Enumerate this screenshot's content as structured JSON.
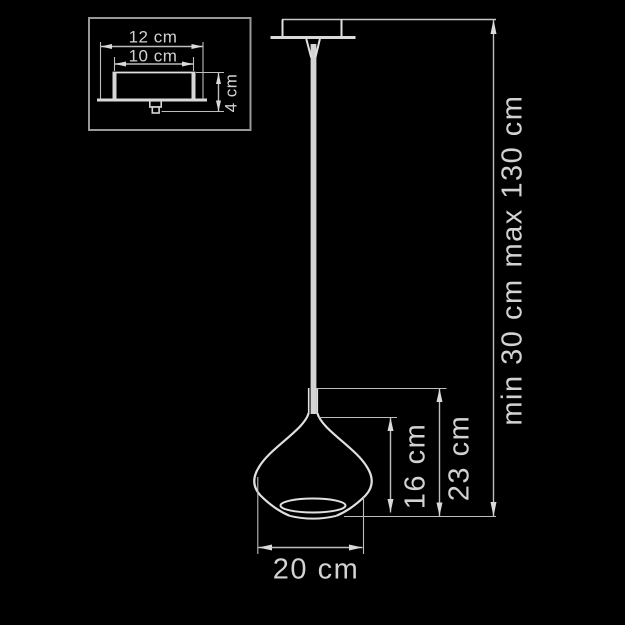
{
  "diagram": {
    "type": "pendant-lamp-dimension-drawing",
    "inset": {
      "outer_width_label": "12 cm",
      "inner_width_label": "10 cm",
      "height_label": "4 cm"
    },
    "main": {
      "shade_height_label": "16 cm",
      "body_height_label": "23 cm",
      "shade_diameter_label": "20 cm",
      "suspension_min_label": "min 30 cm",
      "suspension_max_label": "max 130 cm"
    },
    "colors": {
      "background": "#000000",
      "object_line": "#e0e0e0",
      "dimension_line": "#bdbdbd",
      "text": "#d2d2d2"
    }
  }
}
